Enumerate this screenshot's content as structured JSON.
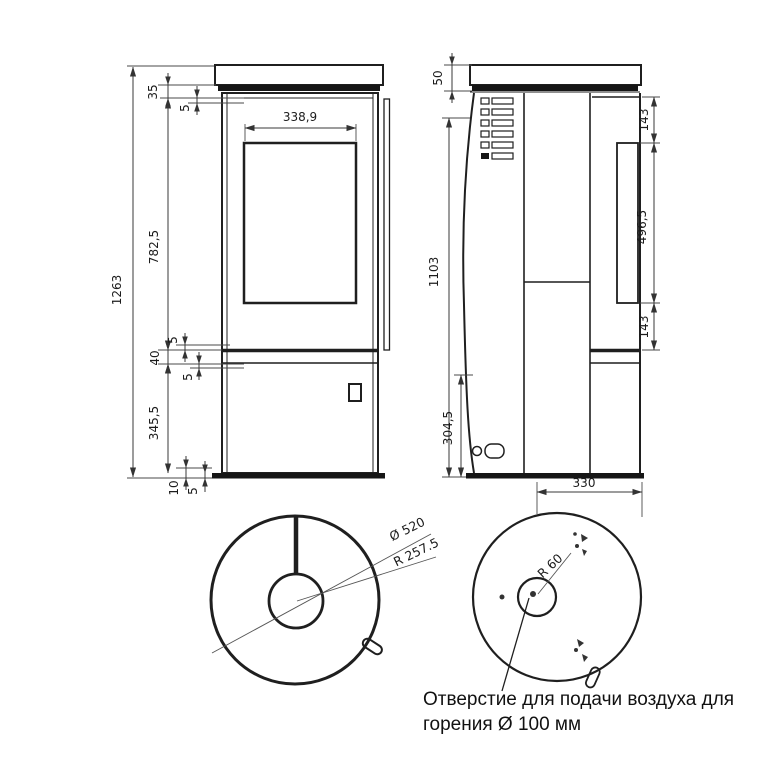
{
  "front_view": {
    "top_gap": "35",
    "top_gap_small": "5",
    "glass_width": "338,9",
    "door_height": "782,5",
    "total_height": "1263",
    "mid_gap_upper": "5",
    "mid_band": "40",
    "mid_gap_lower": "5",
    "lower_panel_height": "345,5",
    "base_height": "10",
    "base_gap": "5"
  },
  "side_view": {
    "top_plate_thickness": "50",
    "body_height": "1103",
    "side_glass_top_offset": "143",
    "side_glass_height": "496,5",
    "side_glass_bottom_offset": "143",
    "lower_section_height": "304,5",
    "base_depth": "330"
  },
  "top_view": {
    "top_plate_diameter": "Ø 520",
    "top_plate_radius": "R 257.5"
  },
  "bottom_view": {
    "air_inlet_radius": "R 60"
  },
  "annotation": {
    "line1": "Отверстие для подачи воздуха для",
    "line2": "горения Ø 100 мм"
  }
}
